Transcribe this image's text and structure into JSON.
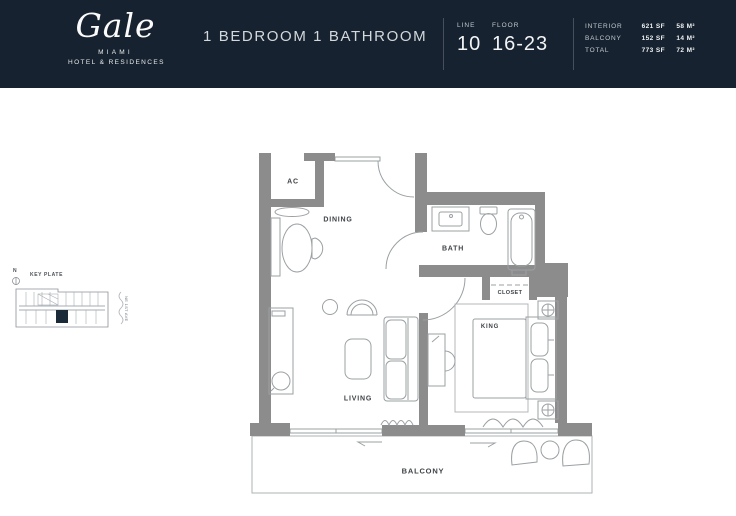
{
  "header": {
    "logo": {
      "name": "Gale",
      "city": "MIAMI",
      "tagline": "HOTEL & RESIDENCES"
    },
    "title": "1 BEDROOM 1 BATHROOM",
    "line": {
      "label": "LINE",
      "value": "10"
    },
    "floor": {
      "label": "FLOOR",
      "value": "16-23"
    },
    "areas": [
      {
        "label": "INTERIOR",
        "sf": "621 SF",
        "m2": "58 M²"
      },
      {
        "label": "BALCONY",
        "sf": "152 SF",
        "m2": "14 M²"
      },
      {
        "label": "TOTAL",
        "sf": "773 SF",
        "m2": "72 M²"
      }
    ]
  },
  "key_plate": {
    "north": "N",
    "title": "KEY PLATE",
    "street": "NE 1ST AVE"
  },
  "rooms": {
    "ac": "AC",
    "dining": "DINING",
    "bath": "BATH",
    "closet": "CLOSET",
    "king": "KING",
    "living": "LIVING",
    "balcony": "BALCONY"
  },
  "colors": {
    "header_bg": "#16222f",
    "wall_gray": "#8c8c8c",
    "line_gray": "#9ba0a3",
    "keyplate_unit": "#1b2a38"
  }
}
